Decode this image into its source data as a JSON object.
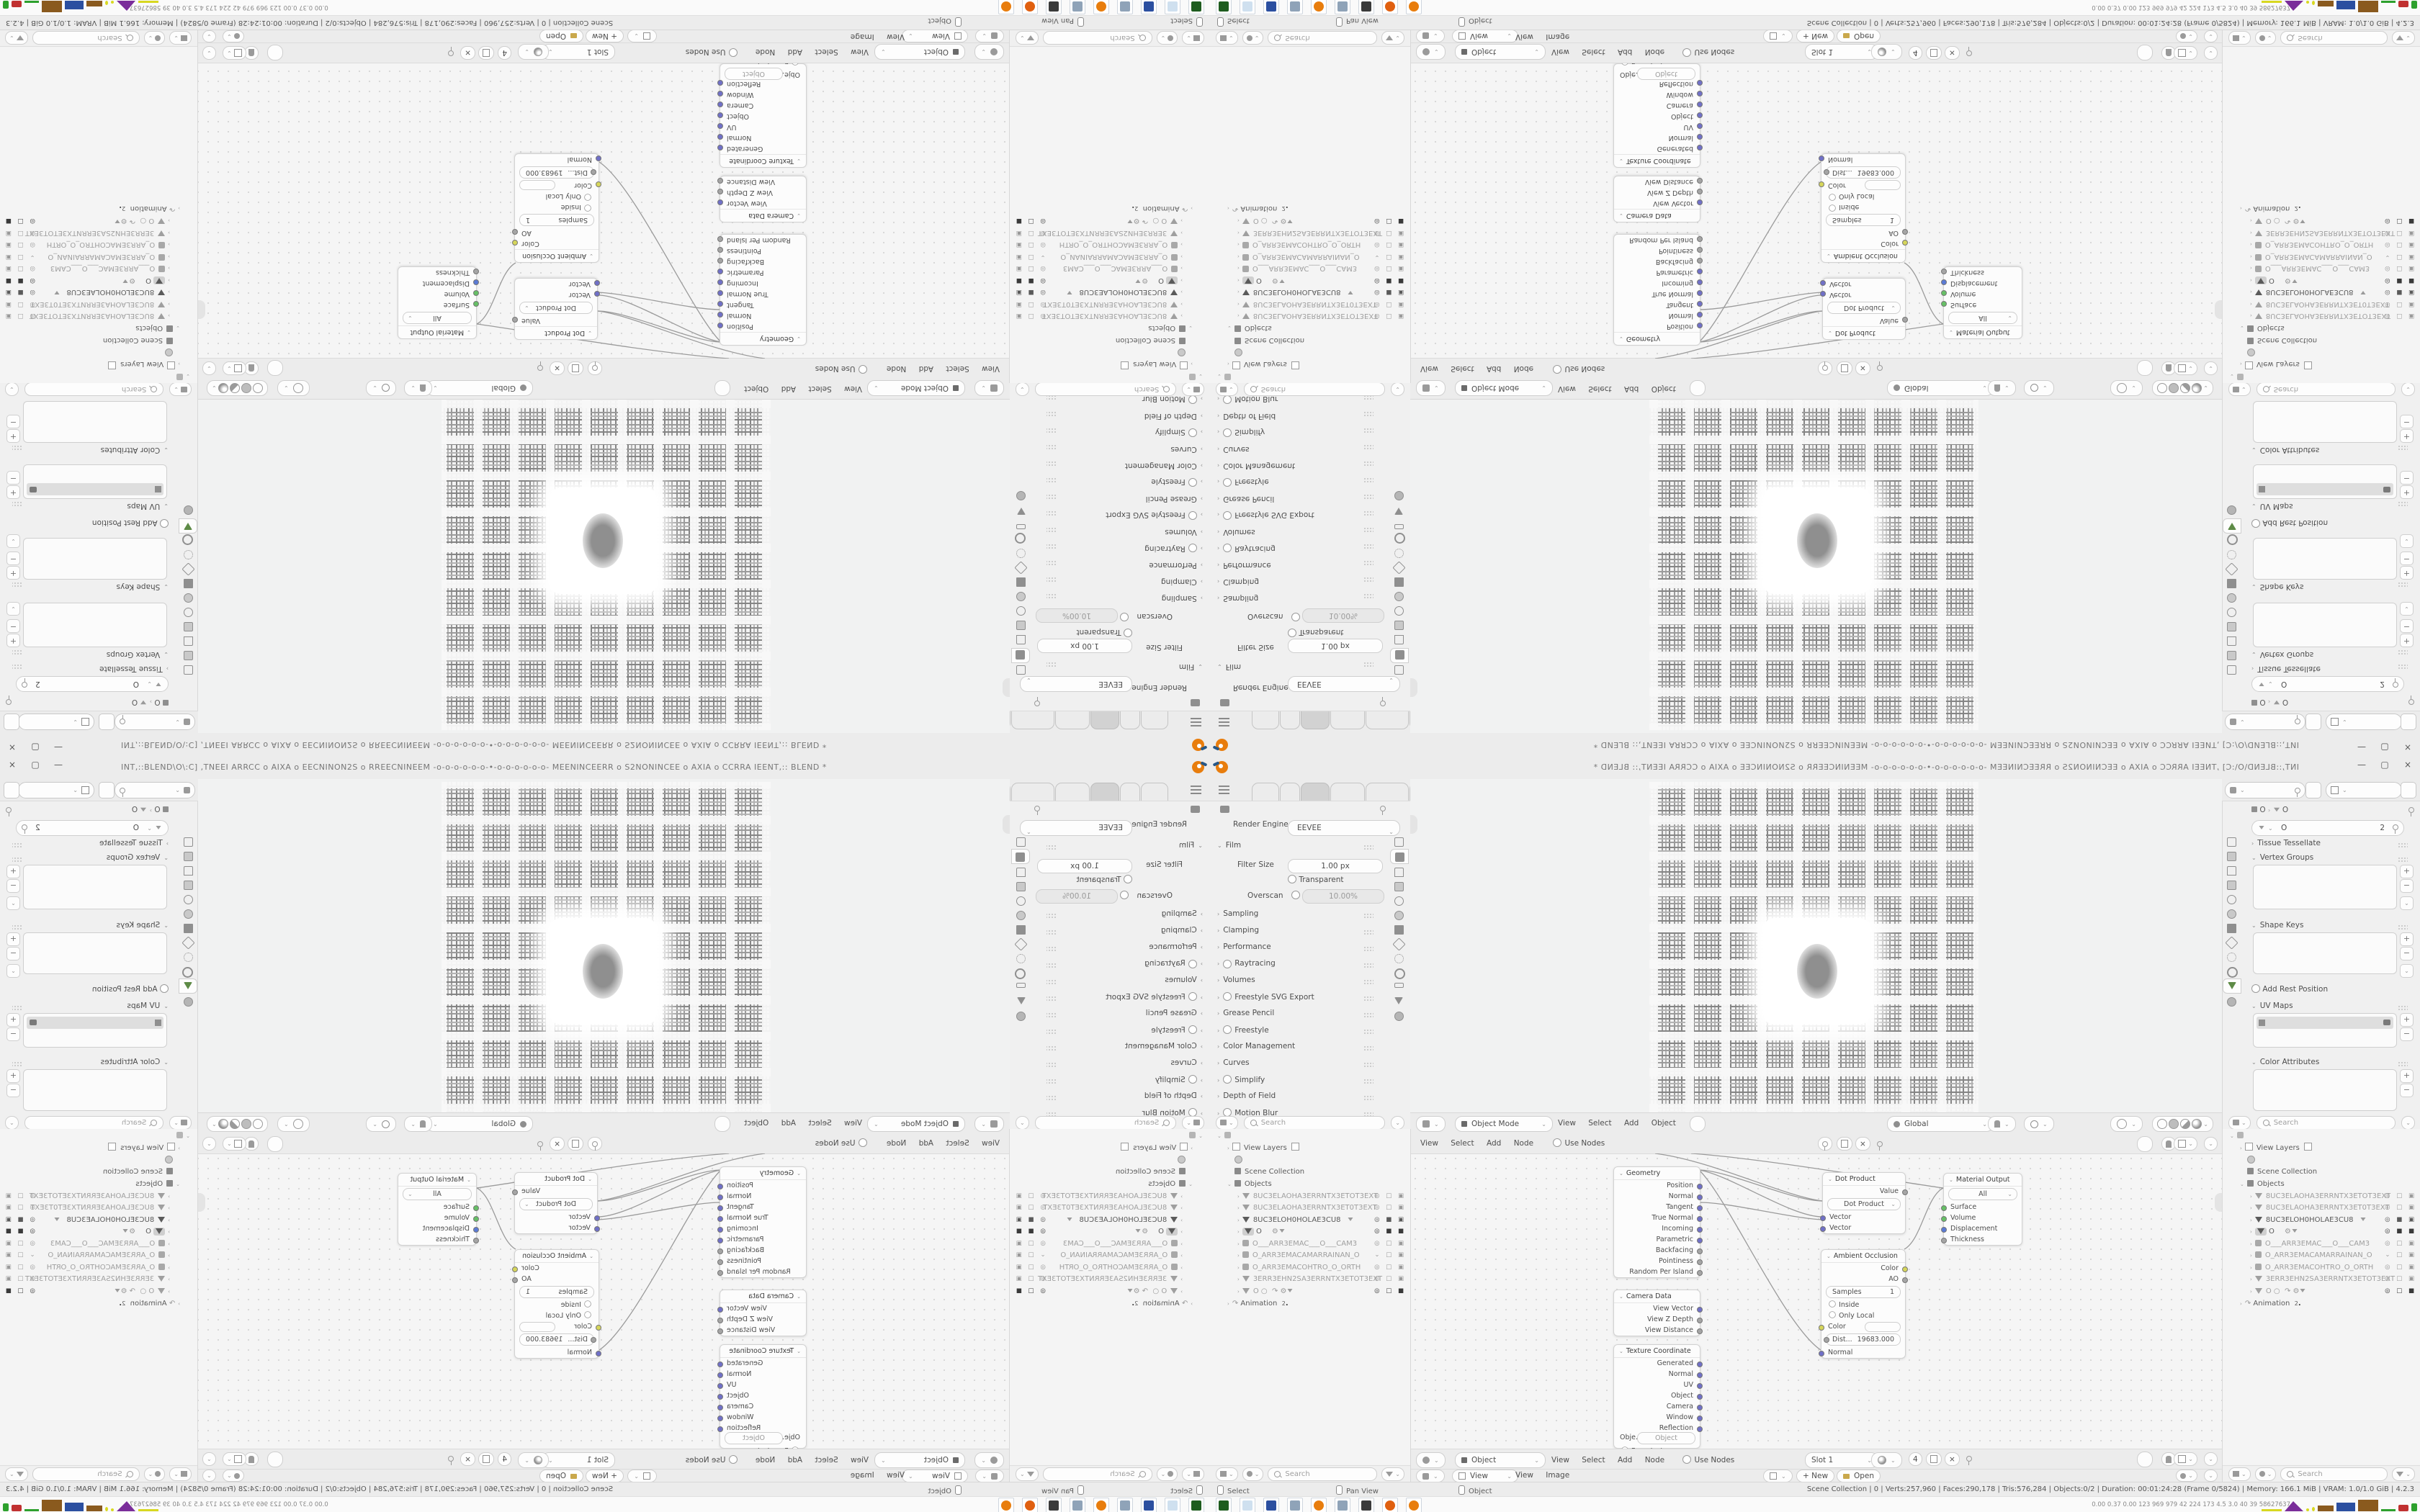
{
  "meta": {
    "app": "Blender 4.2.3 desktop screenshot, 2x2 kaleidoscope-mirrored tiles"
  },
  "colors": {
    "blender_orange": "#e87d0d",
    "socket_vector": "#7070c8",
    "socket_color": "#d6d65a",
    "socket_shader": "#66c066",
    "socket_displacement": "#5a7ad6",
    "panel_bg": "#f0f0f0",
    "chrome_bg": "#ececec"
  },
  "tile": {
    "titlebar": {
      "title": "INT,::BLEND\\O\\:C] ,TNEEI ARRCC o AIXA o EECNINON2S o RREECNINEEM -o-o-o-o-o-o-•-o-o-o-o-o-o- MEENINCEERR o S2NONINCEE o AXIA o CCRRA IEENT,:: BLEND *",
      "minimize": "—",
      "maximize": "▢",
      "close": "×"
    },
    "props_render": {
      "engine_label": "Render Engine",
      "engine_value": "EEVEE",
      "film_label": "Film",
      "filter_label": "Filter Size",
      "filter_value": "1.00 px",
      "transparent_label": "Transparent",
      "overscan_label": "Overscan",
      "overscan_value": "10.00%",
      "sections": [
        "Sampling",
        "Clamping",
        "Performance",
        "Raytracing",
        "Volumes",
        "Freestyle SVG Export",
        "Grease Pencil",
        "Freestyle",
        "Color Management",
        "Curves",
        "Simplify",
        "Depth of Field",
        "Motion Blur"
      ],
      "search_placeholder": "Search"
    },
    "props_mesh": {
      "crumb_object": "O",
      "crumb_sep": "›",
      "crumb_data": "O",
      "name_value": "O",
      "users_count": "2",
      "sections": [
        "Tissue Tessellate",
        "Vertex Groups",
        "Shape Keys",
        "Add Rest Position",
        "UV Maps",
        "Color Attributes"
      ],
      "search_placeholder": "Search"
    },
    "viewport": {
      "mode": "Object Mode",
      "menus": [
        "View",
        "Select",
        "Add",
        "Object"
      ],
      "orientation": "Global"
    },
    "node_editor": {
      "object": "Object",
      "menus": [
        "View",
        "Select",
        "Add",
        "Node"
      ],
      "use_nodes": "Use Nodes",
      "slot": "Slot 1",
      "users_count": "4"
    },
    "image_editor": {
      "view_value": "View",
      "menus": [
        "View",
        "Image"
      ],
      "new_button": "+ New",
      "open_button": "Open"
    },
    "nodes": {
      "geometry": {
        "title": "Geometry",
        "outputs": [
          "Position",
          "Normal",
          "Tangent",
          "True Normal",
          "Incoming",
          "Parametric",
          "Backfacing",
          "Pointiness",
          "Random Per Island"
        ]
      },
      "camera": {
        "title": "Camera Data",
        "outputs": [
          "View Vector",
          "View Z Depth",
          "View Distance"
        ]
      },
      "texcoord": {
        "title": "Texture Coordinate",
        "outputs": [
          "Generated",
          "Normal",
          "UV",
          "Object",
          "Camera",
          "Window",
          "Reflection"
        ],
        "object_label": "Obje...",
        "object_value": "Object",
        "instancer": "From Instancer"
      },
      "dot": {
        "title": "Dot Product",
        "output": "Value",
        "operation": "Dot Product",
        "input1": "Vector",
        "input2": "Vector"
      },
      "ao": {
        "title": "Ambient Occlusion",
        "out1": "Color",
        "out2": "AO",
        "samples_label": "Samples",
        "samples_value": "1",
        "inside": "Inside",
        "only_local": "Only Local",
        "color_label": "Color",
        "dist_label": "Dist...",
        "dist_value": "19683.000",
        "normal": "Normal"
      },
      "output": {
        "title": "Material Output",
        "target": "All",
        "inputs": [
          "Surface",
          "Volume",
          "Displacement",
          "Thickness"
        ]
      }
    },
    "outliner": {
      "view_layers": "View Layers",
      "scene_collection": "Scene Collection",
      "objects": "Objects",
      "animation": "Animation",
      "animation_badge": "2",
      "search_placeholder": "Search",
      "rows": [
        {
          "type": "mesh",
          "name": "8UC3ELAOHA3ERRNTX3ETOT3EXT"
        },
        {
          "type": "mesh",
          "name": "8UC3ELAOHA3ERRNTX3ET0T3EXT"
        },
        {
          "type": "mesh",
          "name": "8UC3ELOH0HOLAE3CU8"
        },
        {
          "type": "mesh-selected",
          "name": "O"
        },
        {
          "type": "camera",
          "name": "O___ARR3EMAC___O___CAM3"
        },
        {
          "type": "camera",
          "name": "O_ARR3EMACAMARRAINAN_O"
        },
        {
          "type": "camera",
          "name": "O_ARR3EMACOHTRO_O_ORTH"
        },
        {
          "type": "mesh",
          "name": "3ERR3EHN2SA3ERRNTX3ETOT3EXT"
        },
        {
          "type": "mesh",
          "name": "O"
        }
      ]
    },
    "statusbar": {
      "hints": [
        "Select",
        "Pan View",
        "Object"
      ],
      "stats": "Scene Collection | 0 | Verts:257,960 | Faces:290,178 | Tris:576,284 | Objects:0/2 | Duration: 00:01:24:28 (Frame 0/5824) | Memory: 166.1 MiB | VRAM: 1.0/1.0 GiB | 4.2.3"
    },
    "taskbar": {
      "numbers": "0.00 0.37 0.00   123   969   979   42   224   173   4.5   3.0   40   39   58627637",
      "icon_colors": [
        "#1e5c1e",
        "#cfe0ef",
        "#2b4fa0",
        "#8fa3b8",
        "#e87d0d",
        "#8fa3b8",
        "#3a3a3a",
        "#e06010",
        "#e87d0d"
      ],
      "graph_colors": {
        "yellow": "#d8d820",
        "purple": "#7a2d9a",
        "brown": "#8a5a1e",
        "blue": "#2b4fa0",
        "green": "#2da02d",
        "red": "#c03030"
      }
    }
  }
}
